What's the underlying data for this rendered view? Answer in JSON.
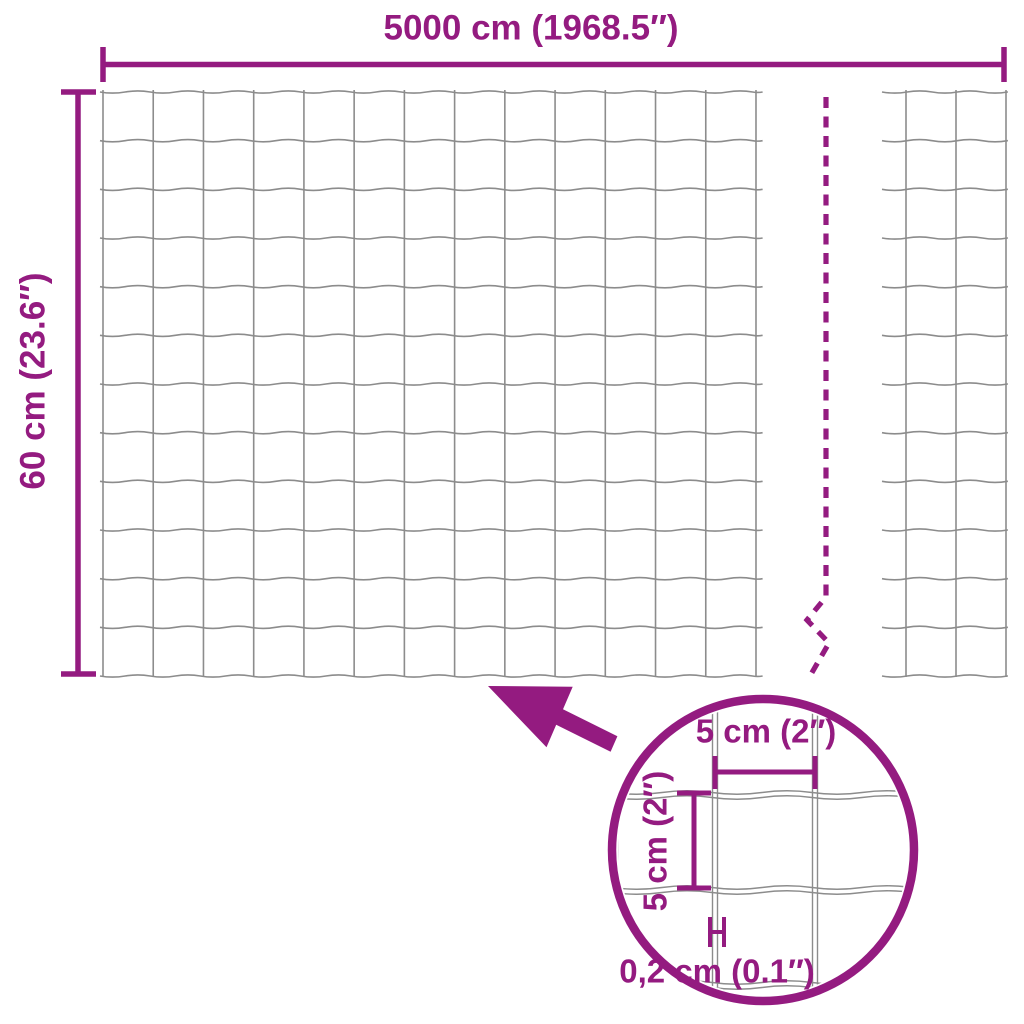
{
  "title": "wire-mesh-fence-dimension-diagram",
  "colors": {
    "accent": "#941B80",
    "wire": "#8C8C8C",
    "background": "#FFFFFF"
  },
  "labels": {
    "total_width": "5000 cm (1968.5″)",
    "total_height": "60 cm (23.6″)",
    "detail_cell_width": "5 cm (2″)",
    "detail_cell_height": "5 cm (2″)",
    "detail_wire_thickness": "0,2 cm (0.1″)"
  },
  "mesh": {
    "wave_amplitude": 2.2,
    "main_panel": {
      "horizontal_wires": 13,
      "vertical_wires": 14,
      "h_x0": 100,
      "h_x1": 763,
      "v_y0": 90,
      "v_y1": 677,
      "first_h_y": 92,
      "h_spacing": 48.667,
      "first_v_x": 103,
      "v_spacing": 50.23
    },
    "right_panel": {
      "horizontal_wires": 13,
      "h_x0": 882,
      "h_x1": 1008,
      "first_h_y": 92,
      "h_spacing": 48.667,
      "verticals": [
        906,
        956,
        1006
      ],
      "v_y0": 90,
      "v_y1": 677
    }
  },
  "break_line": {
    "path": "M 826 97 L 826 597 L 807 620 L 829 643 L 810 676",
    "dash": "11 8.5"
  },
  "detail_view": {
    "circle": {
      "cx": 763,
      "cy": 850,
      "r": 151
    },
    "mesh": {
      "verticals": [
        615,
        715,
        815,
        915
      ],
      "horizontals": [
        700,
        795,
        890,
        985
      ],
      "pair_gap": 5,
      "wave_amplitude": 3.5,
      "period": 100
    }
  }
}
